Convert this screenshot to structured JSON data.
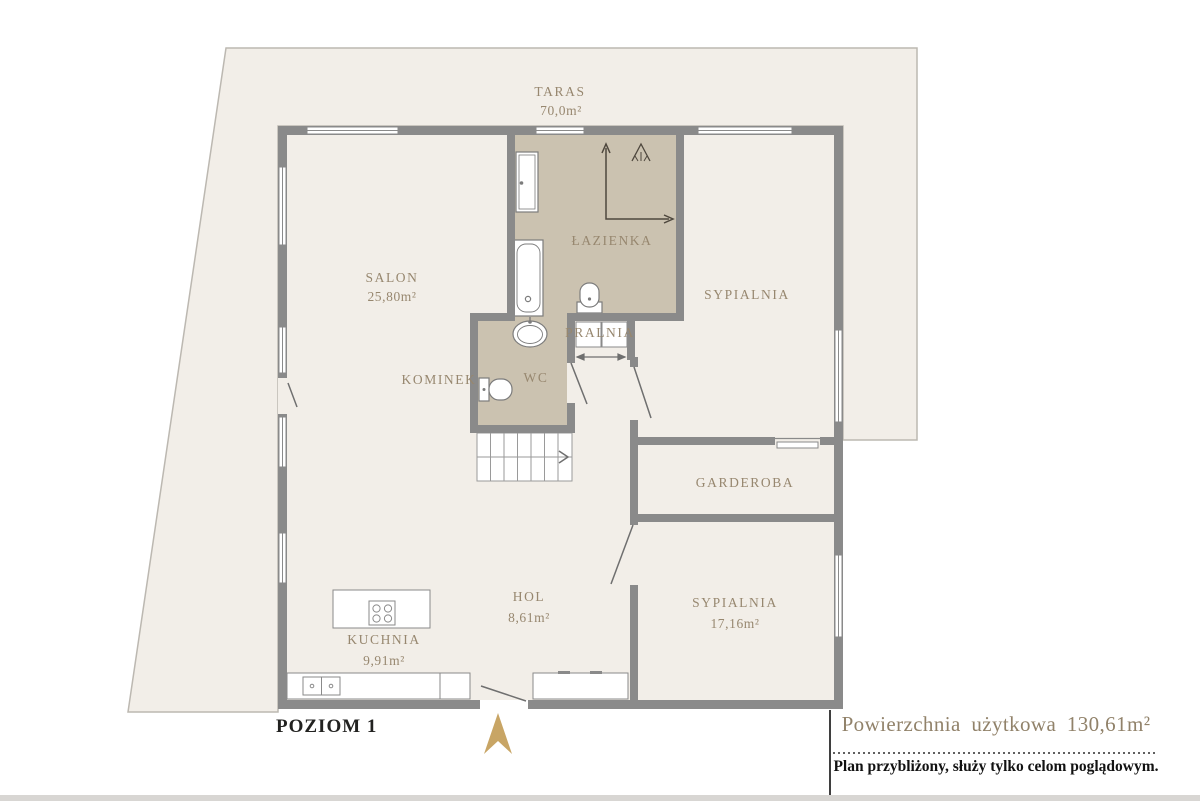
{
  "footer": {
    "level_label": "POZIOM 1",
    "total_area_label": "Powierzchnia użytkowa 130,61m²",
    "disclaimer": "Plan przybliżony, służy tylko celom poglądowym."
  },
  "rooms": {
    "taras": {
      "name": "TARAS",
      "area": "70,0m²"
    },
    "salon": {
      "name": "SALON",
      "area": "25,80m²"
    },
    "lazienka": {
      "name": "ŁAZIENKA"
    },
    "sypialnia_gorna": {
      "name": "SYPIALNIA"
    },
    "pralnia": {
      "name": "PRALNIA"
    },
    "kominek": {
      "name": "KOMINEK"
    },
    "wc": {
      "name": "WC"
    },
    "garderoba": {
      "name": "GARDEROBA"
    },
    "hol": {
      "name": "HOL",
      "area": "8,61m²"
    },
    "kuchnia": {
      "name": "KUCHNIA",
      "area": "9,91m²"
    },
    "sypialnia_dolna": {
      "name": "SYPIALNIA",
      "area": "17,16m²"
    }
  },
  "icons": {
    "north_arrow": "north-arrow"
  },
  "colors": {
    "walls": "#8a8a8a",
    "floor": "#f2eee8",
    "wet_rooms": "#cbc2b0",
    "accent_text": "#97876f",
    "north_arrow": "#c8a565",
    "dark_text": "#1f1f1f"
  }
}
